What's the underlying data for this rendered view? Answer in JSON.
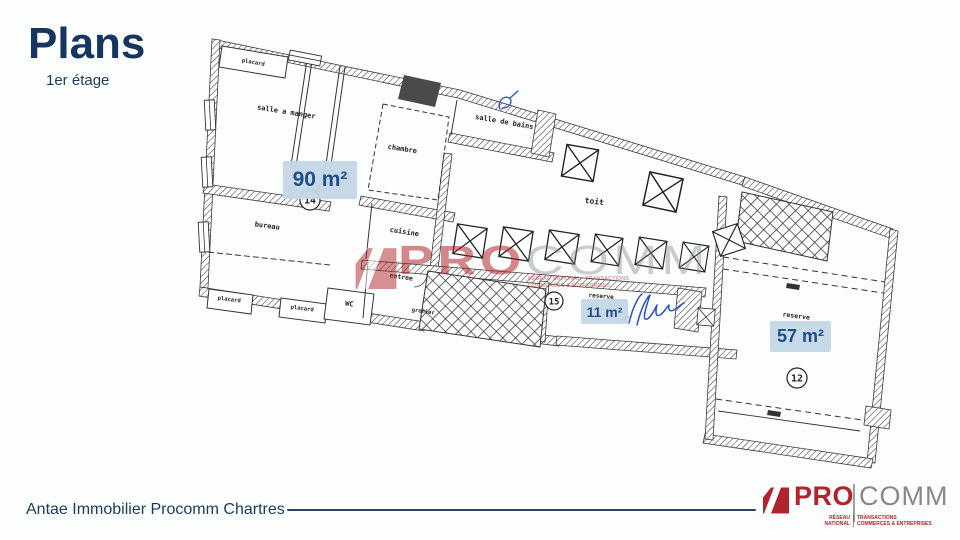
{
  "slide": {
    "title": "Plans",
    "subtitle": "1er étage"
  },
  "floorplan": {
    "rooms": {
      "placard_top": "placard",
      "salle_a_manger": "salle a manger",
      "chambre": "chambre",
      "salle_de_bains": "salle de bains",
      "bureau": "bureau",
      "cuisine": "cuisine",
      "entree": "entree",
      "wc": "WC",
      "placard_bas_1": "placard",
      "placard_bas_2": "placard",
      "grenier": "grenier",
      "toit": "toit",
      "reserve_1": "reserve",
      "reserve_2": "reserve"
    },
    "lots": {
      "l14": "14",
      "l15": "15",
      "l12": "12"
    },
    "areas": {
      "main": "90 m²",
      "small": "11 m²",
      "right": "57 m²"
    },
    "colors": {
      "badge_bg": "#c5d7e8",
      "badge_text": "#1d4e8a",
      "ink": "#2e2e2e",
      "pen_blue": "#2b51c8"
    }
  },
  "watermark": {
    "pro": "PRO",
    "comm": "COMM",
    "tagline": "RÉSEAU NATIONAL · TRANSACTIONS COMMERCES & ENTREPRISES"
  },
  "footer": {
    "agency": "Antae Immobilier Procomm Chartres",
    "logo": {
      "pro": "PRO",
      "comm": "COMM",
      "network_line1": "RÉSEAU",
      "network_line2": "NATIONAL",
      "activity_line1": "TRANSACTIONS",
      "activity_line2": "COMMERCES & ENTREPRISES"
    },
    "colors": {
      "red": "#b2242c",
      "gray": "#86898c",
      "navy": "#1c3a5f"
    }
  }
}
